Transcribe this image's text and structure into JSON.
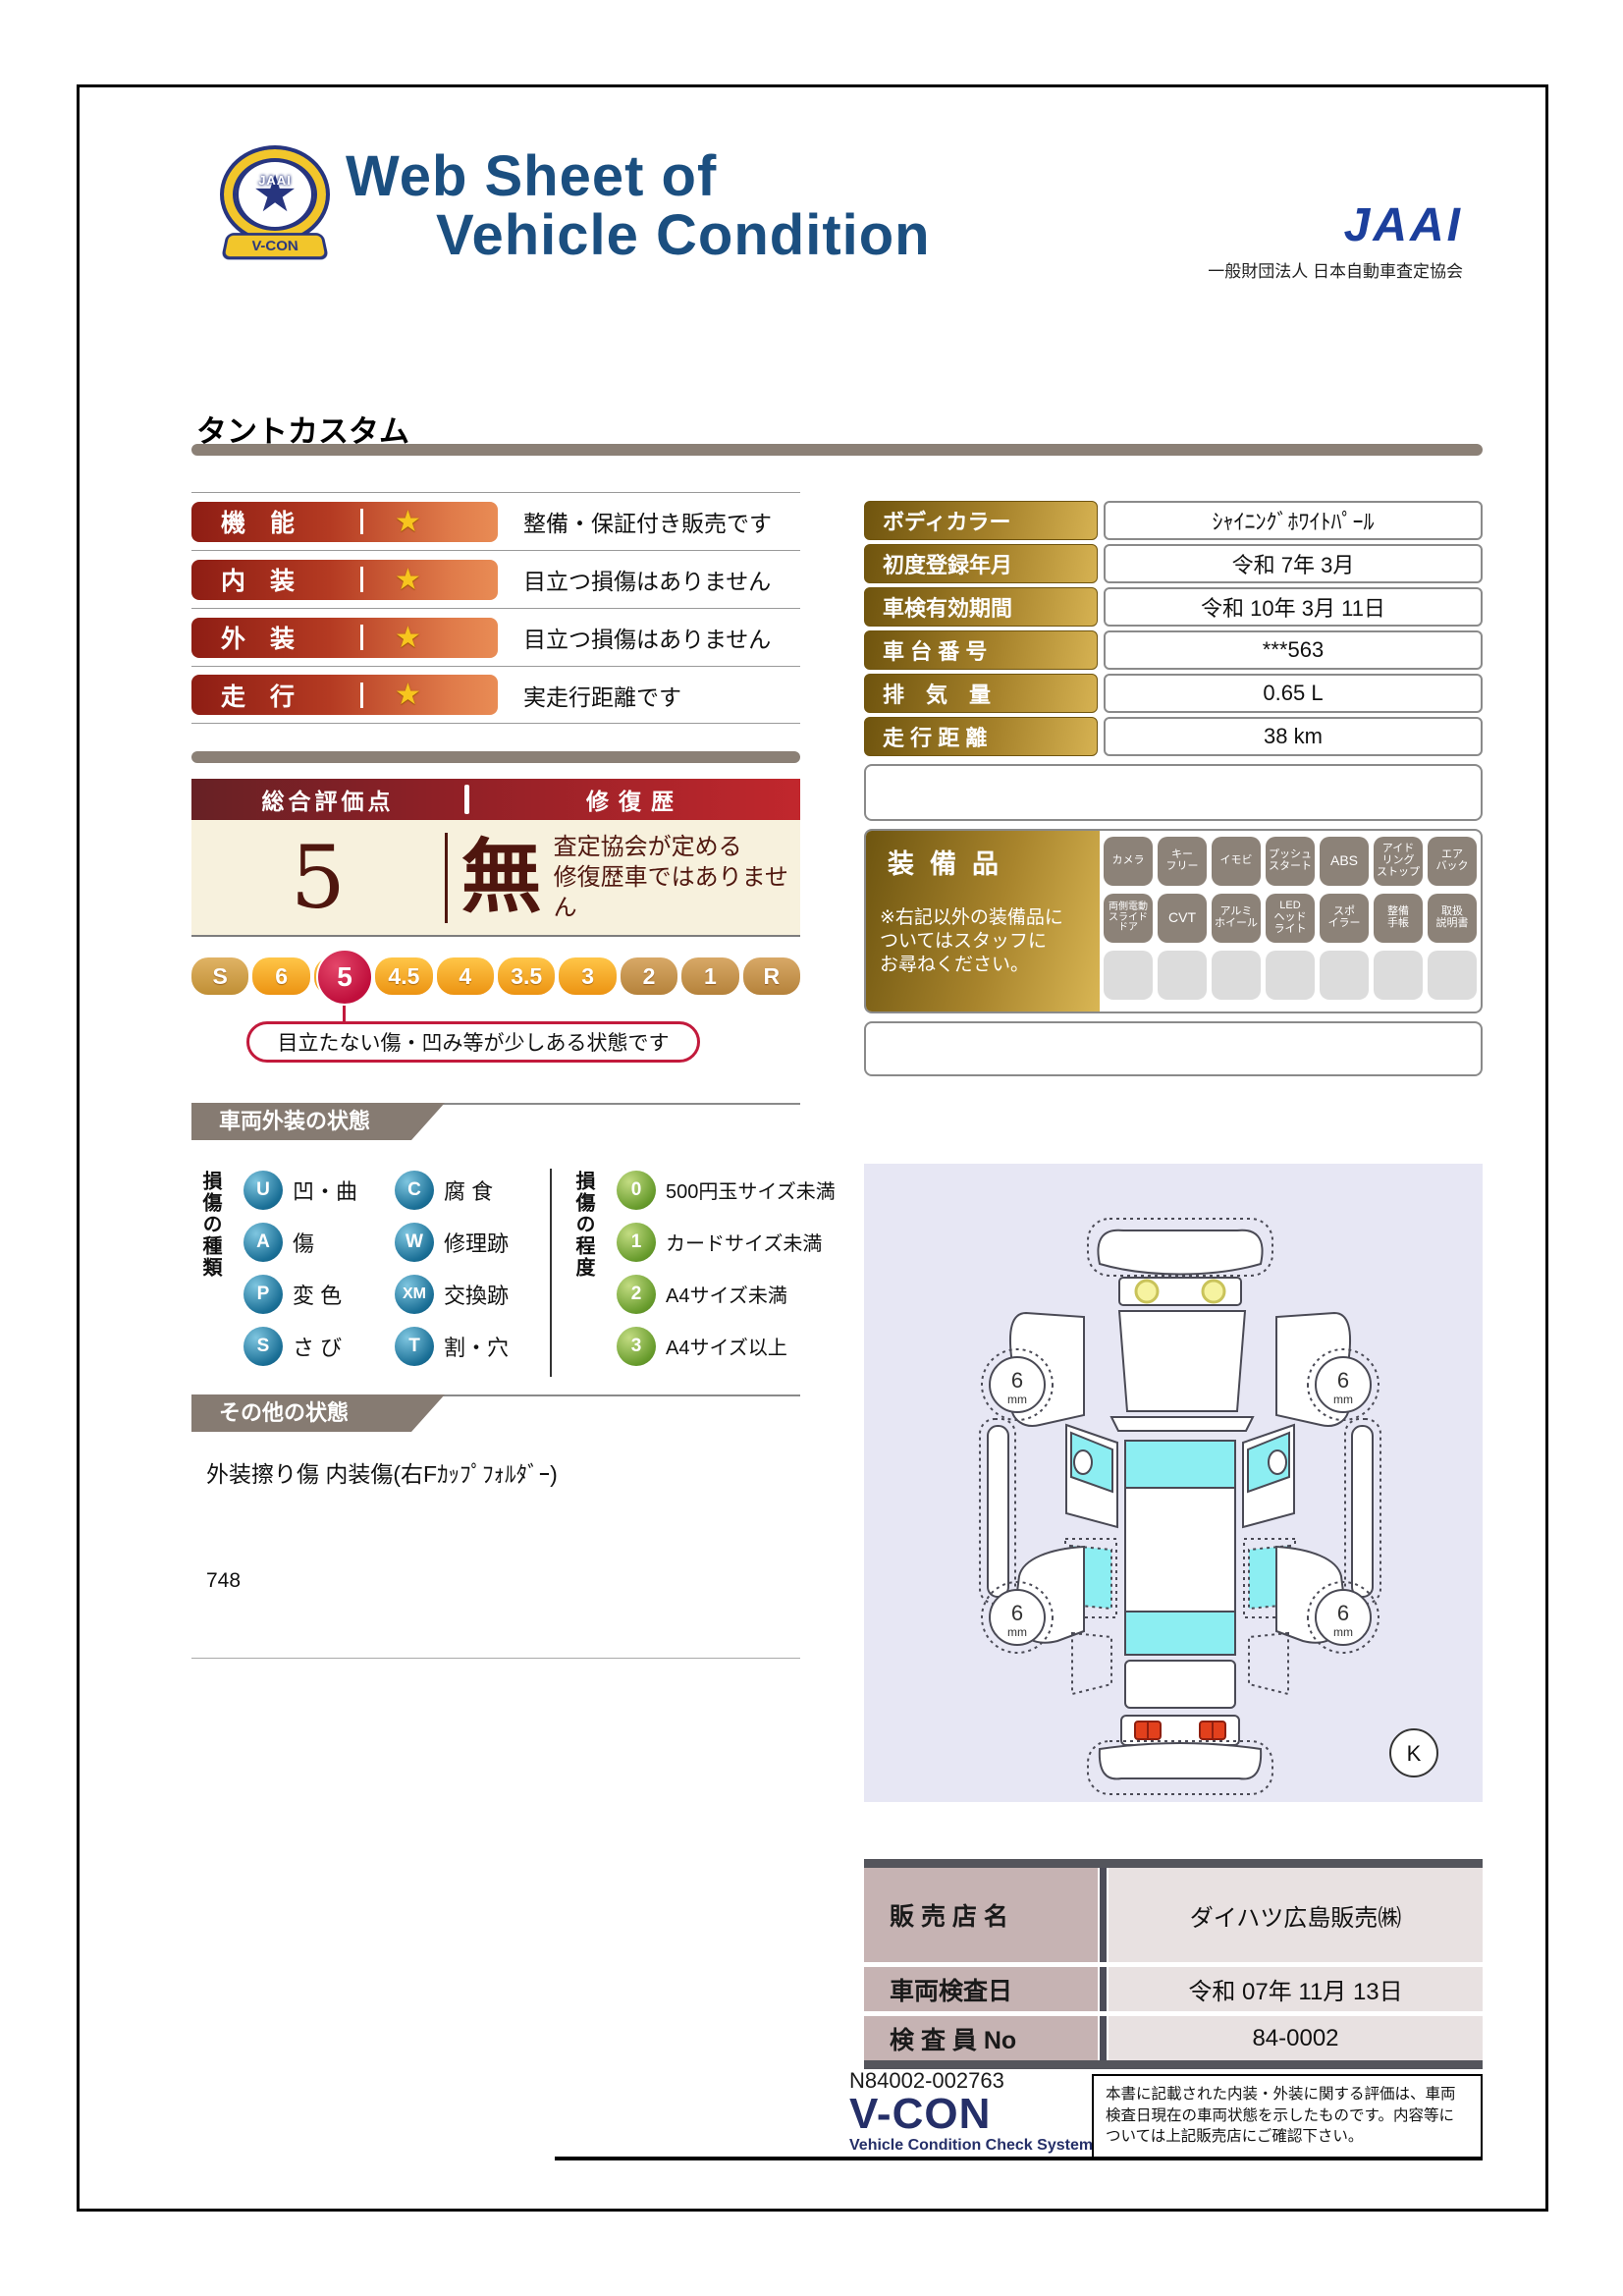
{
  "header": {
    "title_line1": "Web Sheet of",
    "title_line2": "Vehicle Condition",
    "jaai_logo": "JAAI",
    "jaai_subtitle": "一般財団法人 日本自動車査定協会",
    "emblem_center": "JAAI",
    "emblem_ribbon": "V-CON"
  },
  "vehicle_name": "タントカスタム",
  "ratings": [
    {
      "label": "機　能",
      "star": "★",
      "desc": "整備・保証付き販売です"
    },
    {
      "label": "内　装",
      "star": "★",
      "desc": "目立つ損傷はありません"
    },
    {
      "label": "外　装",
      "star": "★",
      "desc": "目立つ損傷はありません"
    },
    {
      "label": "走　行",
      "star": "★",
      "desc": "実走行距離です"
    }
  ],
  "overall": {
    "header_left": "総合評価点",
    "header_right": "修復歴",
    "score": "5",
    "repair_flag": "無",
    "repair_desc": "査定協会が定める\n修復歴車ではありません"
  },
  "scale": {
    "segments": [
      "S",
      "6",
      "5",
      "4.5",
      "4",
      "3.5",
      "3",
      "2",
      "1",
      "R"
    ],
    "selected": "5",
    "callout": "目立たない傷・凹み等が少しある状態です"
  },
  "info_table": {
    "rows": [
      {
        "label": "ボディカラー",
        "value": "ｼｬｲﾆﾝｸﾞﾎﾜｲﾄﾊﾟｰﾙ"
      },
      {
        "label": "初度登録年月",
        "value": "令和 7年 3月"
      },
      {
        "label": "車検有効期間",
        "value": "令和 10年 3月 11日"
      },
      {
        "label": "車 台 番 号",
        "value": "***563"
      },
      {
        "label": "排　気　量",
        "value": "0.65 L"
      },
      {
        "label": "走 行 距 離",
        "value": "38 km"
      }
    ]
  },
  "equipment": {
    "title": "装備品",
    "note": "※右記以外の装備品に\nついてはスタッフに\nお尋ねください。",
    "row1": [
      "カメラ",
      "キー\nフリー",
      "イモビ",
      "プッシュ\nスタート",
      "ABS",
      "アイド\nリング\nストップ",
      "エア\nバック"
    ],
    "row2": [
      "両側電動\nスライド\nドア",
      "CVT",
      "アルミ\nホイール",
      "LED\nヘッド\nライト",
      "スポ\nイラー",
      "整備\n手帳",
      "取扱\n説明書"
    ]
  },
  "exterior_section": {
    "title": "車両外装の状態",
    "type_axis_label": "損傷の種類",
    "types": [
      {
        "code": "U",
        "label": "凹・曲"
      },
      {
        "code": "C",
        "label": "腐 食"
      },
      {
        "code": "A",
        "label": "傷"
      },
      {
        "code": "W",
        "label": "修理跡"
      },
      {
        "code": "P",
        "label": "変 色"
      },
      {
        "code": "XM",
        "label": "交換跡"
      },
      {
        "code": "S",
        "label": "さ び"
      },
      {
        "code": "T",
        "label": "割・穴"
      }
    ],
    "degree_axis_label": "損傷の程度",
    "degrees": [
      {
        "code": "0",
        "label": "500円玉サイズ未満"
      },
      {
        "code": "1",
        "label": "カードサイズ未満"
      },
      {
        "code": "2",
        "label": "A4サイズ未満"
      },
      {
        "code": "3",
        "label": "A4サイズ以上"
      }
    ]
  },
  "other_section": {
    "title": "その他の状態",
    "line1": "外装擦り傷 内装傷(右Fｶｯﾌﾟﾌｫﾙﾀﾞｰ)",
    "line2": "748"
  },
  "diagram": {
    "tread_value": "6",
    "tread_unit": "mm",
    "key_mark": "K"
  },
  "dealer_table": {
    "rows": [
      {
        "label": "販 売 店 名",
        "value": "ダイハツ広島販売㈱"
      },
      {
        "label": "車両検査日",
        "value": "令和 07年 11月 13日"
      },
      {
        "label": "検 査 員 No",
        "value": "84-0002"
      }
    ]
  },
  "footer": {
    "serial": "N84002-002763",
    "vcon": "V-CON",
    "vcon_sub": "Vehicle Condition Check System",
    "disclaimer": "本書に記載された内装・外装に関する評価は、車両検査日現在の車両状態を示したものです。内容等については上記販売店にご確認下さい。"
  },
  "colors": {
    "title_navy": "#1b4f80",
    "jaai_blue": "#1c3f9c",
    "rating_bar_red": "#8e1d14",
    "gold_label": "#a5812a",
    "maroon": "#4f160e",
    "selected_circle": "#c00f3c",
    "section_gray": "#867b72",
    "diagram_bg": "#e7e7f4",
    "glass_cyan": "#8ceef2"
  }
}
